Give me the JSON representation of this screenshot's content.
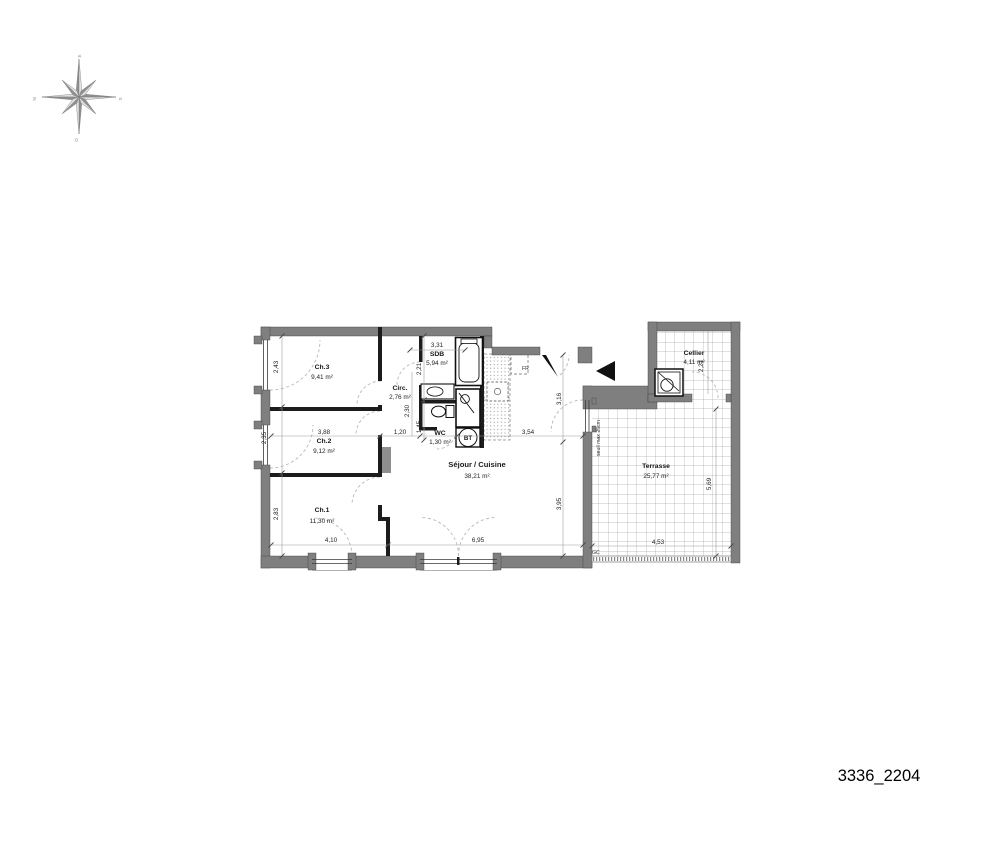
{
  "title": "3336_2204",
  "compass": {
    "n": "N",
    "e": "E",
    "s": "S",
    "o": "O"
  },
  "rooms": {
    "ch3": {
      "name": "Ch.3",
      "area": "9,41 m²"
    },
    "ch2": {
      "name": "Ch.2",
      "area": "9,12 m²"
    },
    "ch1": {
      "name": "Ch.1",
      "area": "11,30 m²"
    },
    "circ": {
      "name": "Circ.",
      "area": "2,76 m²"
    },
    "sdb": {
      "name": "SDB",
      "area": "5,94 m²"
    },
    "wc": {
      "name": "WC",
      "area": "1,30 m²"
    },
    "sejour": {
      "name": "Séjour / Cuisine",
      "area": "38,21 m²"
    },
    "cellier": {
      "name": "Cellier",
      "area": "4,11 m²"
    },
    "terrasse": {
      "name": "Terrasse",
      "area": "25,77 m²"
    }
  },
  "dims": {
    "ch3_h": "2,43",
    "ch2_h": "2,35",
    "ch1_h": "2,83",
    "ch2_w": "3,88",
    "ch1_w": "4,10",
    "sejour_w": "6,95",
    "sdb_w": "3,31",
    "sdb_h": "2,21",
    "wc_h": "2,30",
    "wc_inner": "1,45",
    "circ_w": "1,20",
    "sejour_mid": "3,54",
    "entry_h": "3,16",
    "sejour_h": "3,95",
    "terrasse_w": "4,53",
    "terrasse_h": "5,69",
    "cellier_h": "2,21"
  },
  "annotations": {
    "fridge": "FR",
    "technical_box": "BT",
    "railing": "GC",
    "threshold": "seuil max 25cm"
  }
}
